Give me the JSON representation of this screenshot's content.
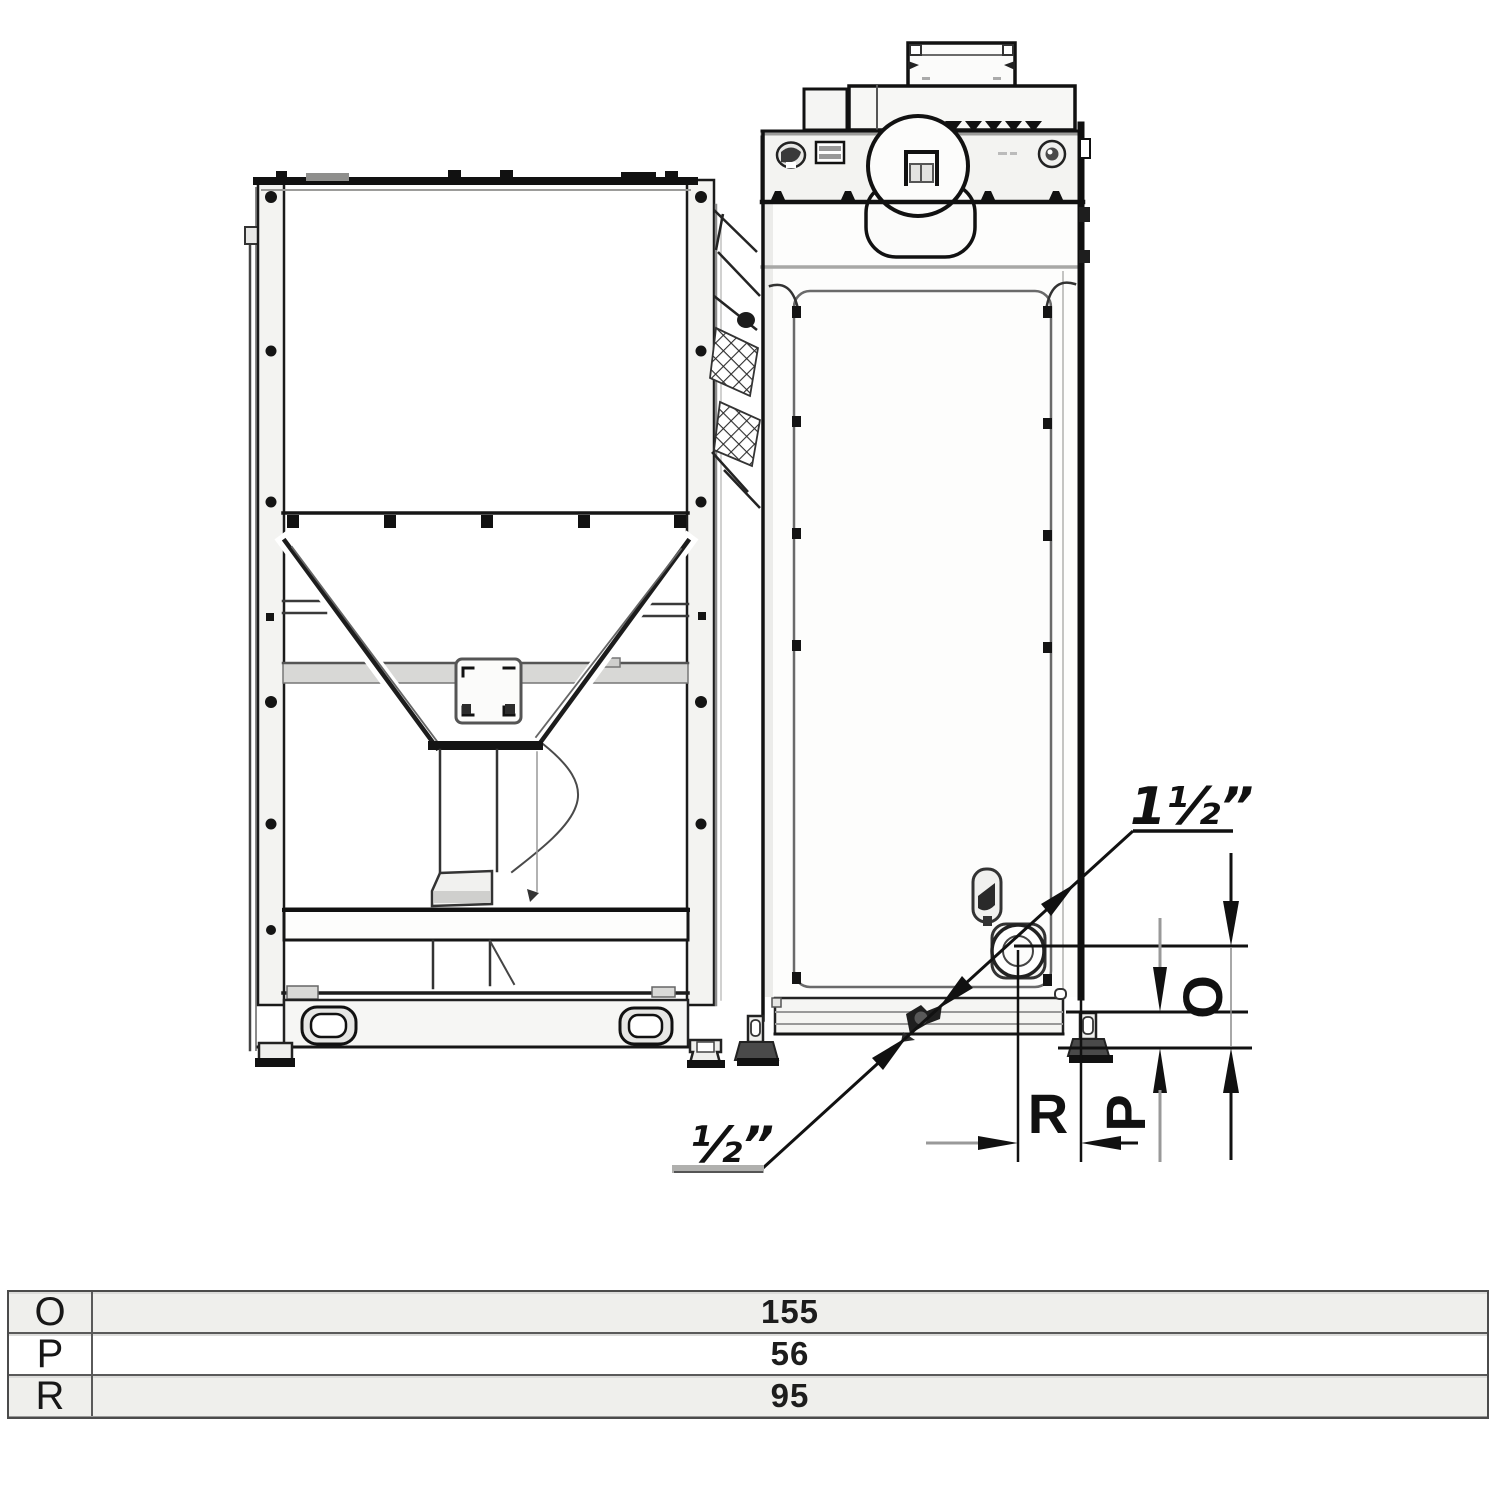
{
  "drawing": {
    "title_semantic": "pellet boiler with fuel hopper - rear connections side elevation",
    "labels": {
      "connection_large": "1½”",
      "connection_small": "½”",
      "dim_o": "O",
      "dim_p": "P",
      "dim_r": "R"
    }
  },
  "table": {
    "rows": [
      {
        "label": "O",
        "value": "155"
      },
      {
        "label": "P",
        "value": "56"
      },
      {
        "label": "R",
        "value": "95"
      }
    ]
  },
  "appearance": {
    "ink": "#161616",
    "secondary_line": "#999999",
    "paper": "#ffffff",
    "panel_fill": "#f3f3f1",
    "band_fill": "#d8d8d6",
    "table_alt_row": "#efefec",
    "table_border": "#5a5a5a"
  }
}
